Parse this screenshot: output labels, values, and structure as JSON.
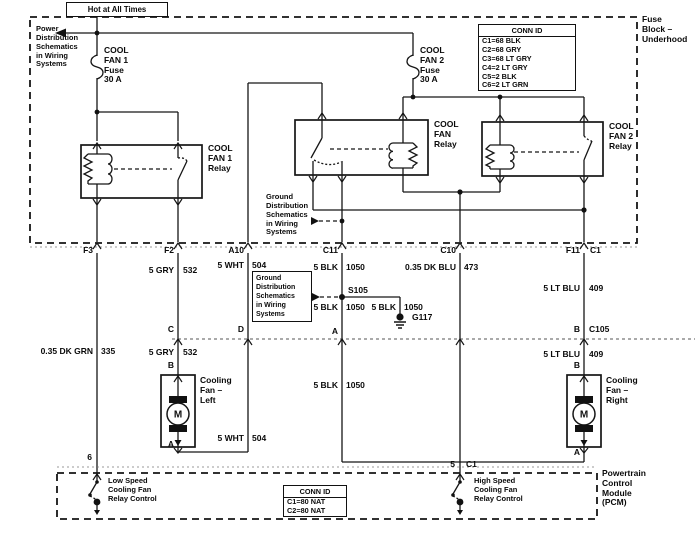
{
  "diagram": {
    "title_box": "Hot at All Times",
    "fuse_block": "Fuse\nBlock –\nUnderhood",
    "pcm": "Powertrain\nControl\nModule\n(PCM)",
    "notes": {
      "power": "Power\nDistribution\nSchematics\nin Wiring\nSystems",
      "ground": "Ground\nDistribution\nSchematics\nin Wiring\nSystems"
    },
    "fuses": {
      "f1": "COOL\nFAN 1\nFuse\n30 A",
      "f2": "COOL\nFAN 2\nFuse\n30 A"
    },
    "relays": {
      "r1": "COOL\nFAN 1\nRelay",
      "mid": "COOL\nFAN\nRelay",
      "r2": "COOL\nFAN 2\nRelay"
    },
    "fans": {
      "left": "Cooling\nFan –\nLeft",
      "right": "Cooling\nFan –\nRight",
      "motor": "M"
    },
    "pcm_controls": {
      "low": "Low Speed\nCooling Fan\nRelay Control",
      "high": "High Speed\nCooling Fan\nRelay Control"
    },
    "conn_id_underhood": {
      "header": "CONN ID",
      "rows": [
        "C1=68 BLK",
        "C2=68 GRY",
        "C3=68 LT GRY",
        "C4=2 LT GRY",
        "C5=2 BLK",
        "C6=2 LT GRN"
      ]
    },
    "conn_id_pcm": {
      "header": "CONN ID",
      "rows": [
        "C1=80 NAT",
        "C2=80 NAT"
      ]
    },
    "pins": {
      "f3": "F3",
      "f2": "F2",
      "a10": "A10",
      "c11": "C11",
      "c10": "C10",
      "f11": "F11",
      "c1": "C1",
      "c": "C",
      "d": "D",
      "a": "A",
      "b": "B",
      "c105": "C105",
      "pin6": "6",
      "pin5": "5"
    },
    "splices": {
      "s105": "S105",
      "g117": "G117"
    },
    "wires": {
      "dk_grn": {
        "name": "0.35 DK GRN",
        "num": "335"
      },
      "gry": {
        "name": "5 GRY",
        "num": "532"
      },
      "wht": {
        "name": "5 WHT",
        "num": "504"
      },
      "blk": {
        "name": "5 BLK",
        "num": "1050"
      },
      "dk_blu": {
        "name": "0.35 DK BLU",
        "num": "473"
      },
      "lt_blu": {
        "name": "5 LT BLU",
        "num": "409"
      }
    },
    "colors": {
      "ink": "#111111",
      "paper": "#ffffff"
    }
  }
}
